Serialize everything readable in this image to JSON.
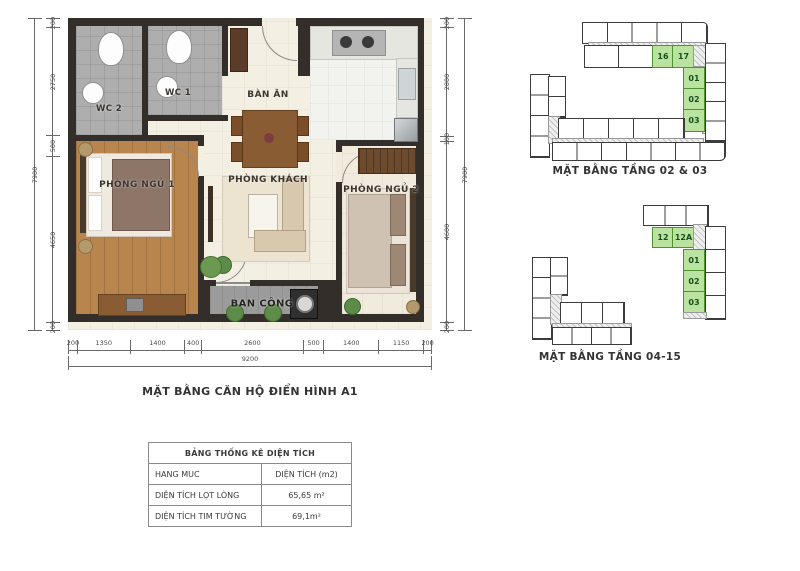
{
  "plan": {
    "caption": "MẶT BẰNG CĂN HỘ ĐIỂN HÌNH A1",
    "rooms": {
      "wc2": "WC 2",
      "wc1": "WC 1",
      "dining": "BÀN ĂN",
      "bedroom1": "PHÒNG NGỦ 1",
      "living": "PHÒNG KHÁCH",
      "bedroom2": "PHÒNG NGỦ 2",
      "balcony": "BAN CÔNG"
    },
    "dimensions": {
      "left": {
        "segments": [
          "200",
          "2750",
          "500",
          "4650",
          "200"
        ],
        "total": "7900"
      },
      "right": {
        "segments": [
          "200",
          "2800",
          "100",
          "4600",
          "200"
        ],
        "total": "7900"
      },
      "bottom": {
        "segments": [
          "200",
          "1350",
          "1400",
          "400",
          "2600",
          "500",
          "1400",
          "1150",
          "200"
        ],
        "total": "9200"
      }
    }
  },
  "diagrams": [
    {
      "caption": "MẶT BẰNG TẦNG 02 & 03",
      "highlighted_units": [
        "16",
        "17",
        "01",
        "02",
        "03"
      ]
    },
    {
      "caption": "MẶT BẰNG TẦNG 04-15",
      "highlighted_units": [
        "12",
        "12A",
        "01",
        "02",
        "03"
      ]
    }
  ],
  "area_table": {
    "title": "BẢNG THỐNG KÊ DIỆN TÍCH",
    "header": {
      "item": "HANG MUC",
      "area": "DIỆN TÍCH (m2)"
    },
    "rows": [
      {
        "item": "DIỆN TÍCH LỌT LÒNG",
        "area": "65,65 m²"
      },
      {
        "item": "DIỆN TÍCH TIM TƯỜNG",
        "area": "69,1m²"
      }
    ]
  },
  "colors": {
    "wall": "#332e29",
    "highlight_green": "#b9e39e",
    "wood_floor": "#b9854e",
    "wc_floor": "#aeaeae"
  }
}
